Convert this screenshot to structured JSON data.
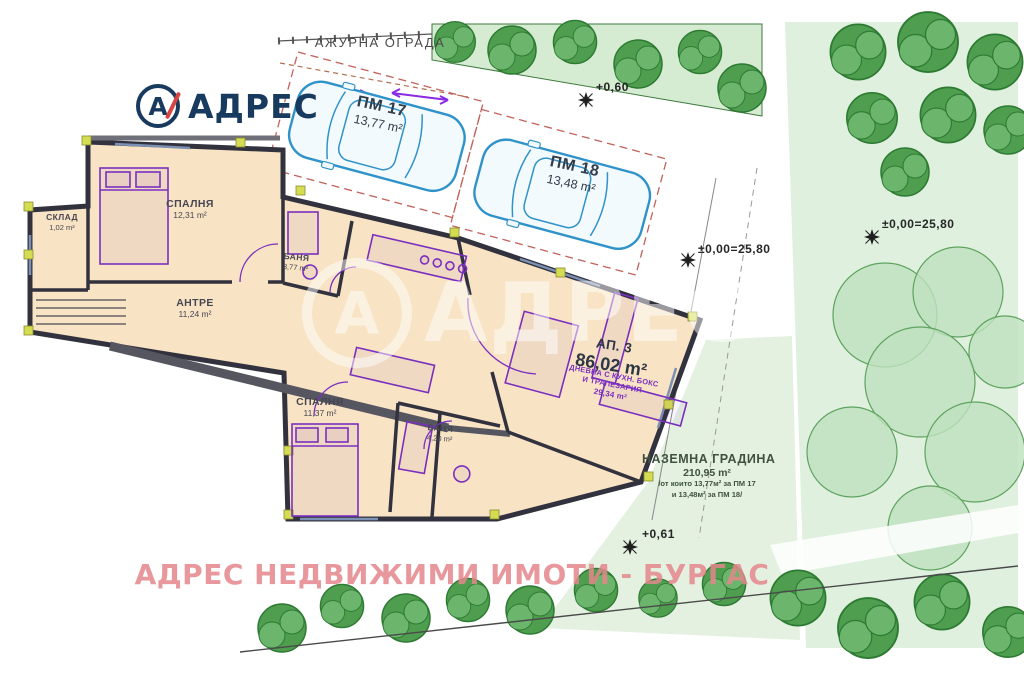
{
  "brand": {
    "logo_letter": "А",
    "logo_text": "АДРЕС"
  },
  "site": {
    "fence_label": "АЖУРНА ОГРАДА",
    "elevations": [
      "+0,60",
      "±0,00=25,80",
      "±0,00=25,80",
      "+0,61"
    ]
  },
  "parking": {
    "spots": [
      {
        "name": "ПМ 17",
        "area": "13,77 m²"
      },
      {
        "name": "ПМ 18",
        "area": "13,48 m²"
      }
    ]
  },
  "apartment": {
    "name": "АП. 3",
    "area": "86,02 m²",
    "living_room": {
      "line1": "ДНЕВНА С КУХН. БОКС",
      "line2": "И ТРАПЕЗАРИЯ",
      "area": "29,34 m²"
    },
    "rooms": [
      {
        "name": "СПАЛНЯ",
        "area": "12,31 m²"
      },
      {
        "name": "СКЛАД",
        "area": "1,02 m²"
      },
      {
        "name": "АНТРЕ",
        "area": "11,24 m²"
      },
      {
        "name": "БАНЯ",
        "area": "3,77 m²"
      },
      {
        "name": "СПАЛНЯ",
        "area": "11,37 m²"
      },
      {
        "name": "БАНЯ",
        "area": "4,20 m²"
      }
    ]
  },
  "garden": {
    "title": "НАЗЕМНА ГРАДИНА",
    "area": "210,95 m²",
    "note_line1": "/от които 13,77м² за ПМ 17",
    "note_line2": "и 13,48м² за ПМ 18/"
  },
  "watermarks": {
    "center_letter": "А",
    "center_text": "АДРЕС",
    "footer_text": "АДРЕС НЕДВИЖИМИ ИМОТИ - БУРГАС"
  },
  "colors": {
    "brand_navy": "#173a5e",
    "brand_red": "#d64541",
    "wall": "#32323f",
    "floor_fill": "#f8e4c4",
    "furniture_purple": "#7a2fbf",
    "car_blue": "#2f93c9",
    "stall_dash_red": "#c2625c",
    "tree_dark": "#4f9e4f",
    "tree_light": "#bfe3bf",
    "lawn": "#dff0df",
    "watermark_pink": "#e4878c"
  }
}
